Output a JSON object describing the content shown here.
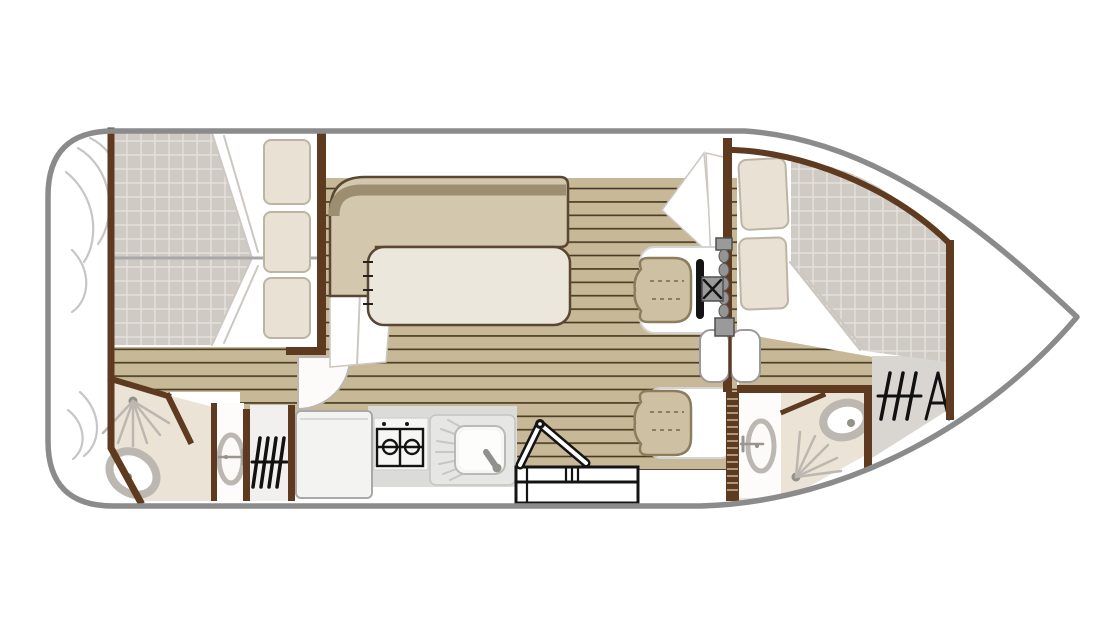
{
  "meta": {
    "type": "boat-floor-plan",
    "view": "top-down",
    "orientation": "bow-right",
    "canvas": {
      "width": 1120,
      "height": 640,
      "background": "#ffffff"
    }
  },
  "palette": {
    "hull": "#8b8b8b",
    "wall": "#5e3a21",
    "plank": "#c7b897",
    "plankLine": "#46391f",
    "quilt": "#d0cac5",
    "quiltLine": "#e5e1dd",
    "bench": "#d3c7ad",
    "benchBack": "#9d8d71",
    "benchOutline": "#594733",
    "table": "#ece7dc",
    "pillow": "#e9e2d4",
    "pillowEdge": "#bdb4a4",
    "chair": "#cec0a3",
    "chairOutline": "#8d7c5e",
    "mat": "#ffffff",
    "matEdge": "#d4d4d4",
    "counter": "#dbdbd9",
    "bath": "#ebe3d6",
    "fixture": "#bcb7b0",
    "fixtureDot": "#94908a",
    "wardrobe": "#d9d6d2",
    "foldLine": "#ccc7c0",
    "stepOutline": "#141414",
    "steel": "#9a9a9a",
    "fridge": "#f3f3f1",
    "knob": "#949494",
    "white": "#ffffff",
    "divider": "#a8a8a8",
    "deco": "#c6c6c6",
    "sinkBody": "#e6e6e4",
    "louverTick": "#c9b89b"
  },
  "legend": {
    "areas": [
      "stern-deck",
      "aft-cabin-twin-berths",
      "aft-bathroom-shower-toilet",
      "washbasin-nook-aft",
      "wardrobe-aft",
      "galley",
      "salon-dinette",
      "companionway-steps",
      "helm-station",
      "walkway-planked-deck",
      "bow-cabin-double-berth",
      "forward-bathroom-shower-toilet",
      "wardrobe-forward",
      "bow-deck"
    ],
    "fixtures": [
      "bed-quilt",
      "pillows",
      "l-shaped-bench",
      "salon-table",
      "two-burner-stove",
      "sink-with-drainboard",
      "fridge",
      "steps-with-handrail",
      "helm-seat",
      "steering-wheel",
      "instrument-knobs",
      "guest-seat",
      "double-swing-door",
      "louvered-door",
      "door-swing-arc",
      "shower-spray",
      "toilet",
      "washbasin",
      "faucet",
      "clothes-hanger-icons",
      "rope-coil-decoration"
    ]
  }
}
